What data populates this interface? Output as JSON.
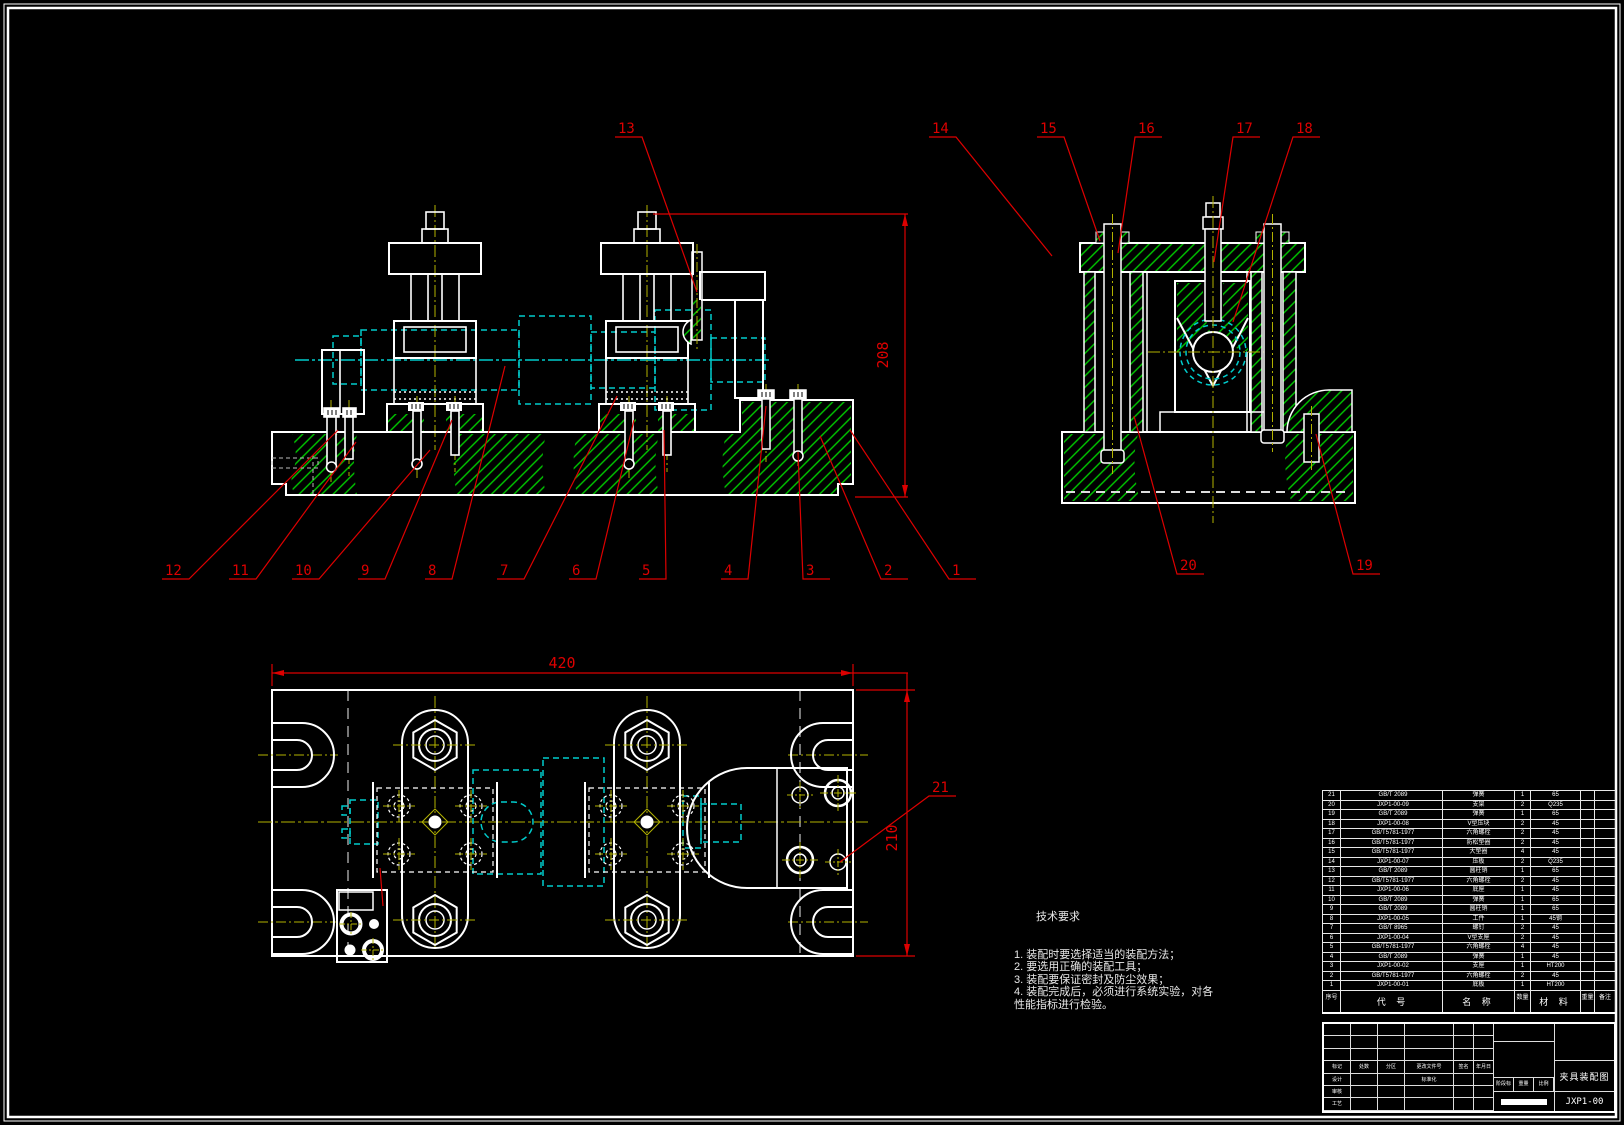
{
  "tech_requirements": {
    "title": "技术要求",
    "lines": [
      "1. 装配时要选择适当的装配方法；",
      "2. 要选用正确的装配工具；",
      "3. 装配要保证密封及防尘效果；",
      "4. 装配完成后，必须进行系统实验，对各",
      "性能指标进行检验。"
    ]
  },
  "dimensions": {
    "front_height": "208",
    "plan_width": "420",
    "plan_height": "210"
  },
  "callouts": [
    {
      "label": "1",
      "lx": 952,
      "ly": 575,
      "ex": 850,
      "ey": 430
    },
    {
      "label": "2",
      "lx": 884,
      "ly": 575,
      "ex": 820,
      "ey": 436
    },
    {
      "label": "3",
      "lx": 806,
      "ly": 575,
      "ex": 798,
      "ey": 452
    },
    {
      "label": "4",
      "lx": 724,
      "ly": 575,
      "ex": 766,
      "ey": 406
    },
    {
      "label": "5",
      "lx": 642,
      "ly": 575,
      "ex": 664,
      "ey": 430
    },
    {
      "label": "6",
      "lx": 572,
      "ly": 575,
      "ex": 634,
      "ey": 420
    },
    {
      "label": "7",
      "lx": 500,
      "ly": 575,
      "ex": 617,
      "ey": 396
    },
    {
      "label": "8",
      "lx": 428,
      "ly": 575,
      "ex": 505,
      "ey": 366
    },
    {
      "label": "9",
      "lx": 361,
      "ly": 575,
      "ex": 452,
      "ey": 420
    },
    {
      "label": "10",
      "lx": 295,
      "ly": 575,
      "ex": 430,
      "ey": 450
    },
    {
      "label": "11",
      "lx": 232,
      "ly": 575,
      "ex": 356,
      "ey": 442
    },
    {
      "label": "12",
      "lx": 165,
      "ly": 575,
      "ex": 338,
      "ey": 430
    },
    {
      "label": "13",
      "lx": 618,
      "ly": 133,
      "ex": 697,
      "ey": 292
    },
    {
      "label": "14",
      "lx": 932,
      "ly": 133,
      "ex": 1052,
      "ey": 256
    },
    {
      "label": "15",
      "lx": 1040,
      "ly": 133,
      "ex": 1100,
      "ey": 241
    },
    {
      "label": "16",
      "lx": 1138,
      "ly": 133,
      "ex": 1118,
      "ey": 253
    },
    {
      "label": "17",
      "lx": 1236,
      "ly": 133,
      "ex": 1214,
      "ey": 262
    },
    {
      "label": "18",
      "lx": 1296,
      "ly": 133,
      "ex": 1233,
      "ey": 322
    },
    {
      "label": "19",
      "lx": 1356,
      "ly": 570,
      "ex": 1316,
      "ey": 434
    },
    {
      "label": "20",
      "lx": 1180,
      "ly": 570,
      "ex": 1134,
      "ey": 416
    },
    {
      "label": "21",
      "lx": 932,
      "ly": 792,
      "ex": 840,
      "ey": 862
    }
  ],
  "parts_list": {
    "headers": {
      "seq": "序号",
      "code": "代  号",
      "name": "名  称",
      "qty": "数量",
      "material": "材  料",
      "weight": "重量",
      "note": "备注"
    },
    "rows": [
      {
        "seq": "21",
        "code": "GB/T 2089",
        "name": "弹簧",
        "qty": "1",
        "material": "65",
        "weight": "",
        "note": ""
      },
      {
        "seq": "20",
        "code": "JXP1-00-09",
        "name": "支架",
        "qty": "2",
        "material": "Q235",
        "weight": "",
        "note": ""
      },
      {
        "seq": "19",
        "code": "GB/T 2089",
        "name": "弹簧",
        "qty": "1",
        "material": "65",
        "weight": "",
        "note": ""
      },
      {
        "seq": "18",
        "code": "JXP1-00-08",
        "name": "V型压块",
        "qty": "2",
        "material": "45",
        "weight": "",
        "note": ""
      },
      {
        "seq": "17",
        "code": "GB/T5781-1977",
        "name": "六角螺栓",
        "qty": "2",
        "material": "45",
        "weight": "",
        "note": ""
      },
      {
        "seq": "16",
        "code": "GB/T5781-1977",
        "name": "防松垫圈",
        "qty": "2",
        "material": "45",
        "weight": "",
        "note": ""
      },
      {
        "seq": "15",
        "code": "GB/T5781-1977",
        "name": "大垫圈",
        "qty": "4",
        "material": "45",
        "weight": "",
        "note": ""
      },
      {
        "seq": "14",
        "code": "JXP1-00-07",
        "name": "压板",
        "qty": "2",
        "material": "Q235",
        "weight": "",
        "note": ""
      },
      {
        "seq": "13",
        "code": "GB/T 2089",
        "name": "圆柱销",
        "qty": "1",
        "material": "65",
        "weight": "",
        "note": ""
      },
      {
        "seq": "12",
        "code": "GB/T5781-1977",
        "name": "六角螺栓",
        "qty": "2",
        "material": "45",
        "weight": "",
        "note": ""
      },
      {
        "seq": "11",
        "code": "JXP1-00-06",
        "name": "底座",
        "qty": "1",
        "material": "45",
        "weight": "",
        "note": ""
      },
      {
        "seq": "10",
        "code": "GB/T 2089",
        "name": "弹簧",
        "qty": "1",
        "material": "65",
        "weight": "",
        "note": ""
      },
      {
        "seq": "9",
        "code": "GB/T 2089",
        "name": "圆柱销",
        "qty": "1",
        "material": "65",
        "weight": "",
        "note": ""
      },
      {
        "seq": "8",
        "code": "JXP1-00-05",
        "name": "工件",
        "qty": "1",
        "material": "45钢",
        "weight": "",
        "note": ""
      },
      {
        "seq": "7",
        "code": "GB/T 8965",
        "name": "螺钉",
        "qty": "2",
        "material": "45",
        "weight": "",
        "note": ""
      },
      {
        "seq": "6",
        "code": "JXP1-00-04",
        "name": "V型支座",
        "qty": "2",
        "material": "45",
        "weight": "",
        "note": ""
      },
      {
        "seq": "5",
        "code": "GB/T5781-1977",
        "name": "六角螺栓",
        "qty": "4",
        "material": "45",
        "weight": "",
        "note": ""
      },
      {
        "seq": "4",
        "code": "GB/T 2089",
        "name": "弹簧",
        "qty": "1",
        "material": "45",
        "weight": "",
        "note": ""
      },
      {
        "seq": "3",
        "code": "JXP1-00-02",
        "name": "支座",
        "qty": "1",
        "material": "HT200",
        "weight": "",
        "note": ""
      },
      {
        "seq": "2",
        "code": "GB/T5781-1977",
        "name": "六角螺栓",
        "qty": "2",
        "material": "45",
        "weight": "",
        "note": ""
      },
      {
        "seq": "1",
        "code": "JXP1-00-01",
        "name": "底板",
        "qty": "1",
        "material": "HT200",
        "weight": "",
        "note": ""
      }
    ]
  },
  "title_block": {
    "title": "夹具装配图",
    "code": "JXP1-00",
    "labels": {
      "mark": "标记",
      "places": "处数",
      "zone": "分区",
      "change_no": "更改文件号",
      "sign": "签名",
      "date": "年月日",
      "design": "设计",
      "check": "审核",
      "process": "工艺",
      "std": "标准化",
      "stage": "阶段标记",
      "weight": "重量",
      "scale": "比例"
    }
  },
  "colors": {
    "line": "#ffffff",
    "hatch": "#00cc00",
    "center": "#b2b200",
    "phantom": "#00cccc",
    "annotation": "#dd0000"
  }
}
